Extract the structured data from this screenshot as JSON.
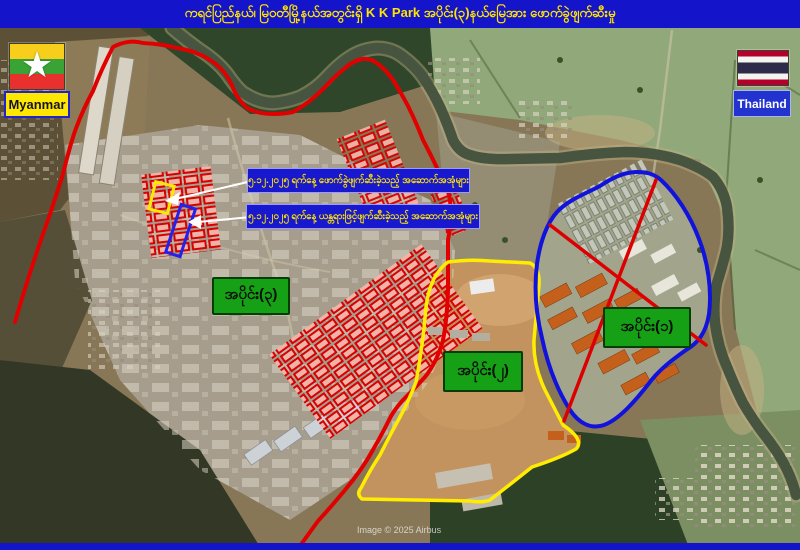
{
  "header": {
    "title": "ကရင်ပြည်နယ်၊ မြဝတီမြို့နယ်အတွင်းရှိ  K K Park အပိုင်း(၃)နယ်မြေအား ဖောက်ခွဲဖျက်ဆီးမှု",
    "bar_color": "#1414cb",
    "text_color": "#ffe400"
  },
  "map": {
    "myanmar_flag_label": "Myanmar",
    "thailand_flag_label": "Thailand",
    "star_icon": "★",
    "callouts": [
      {
        "text": "၅.၁၂.၂၀၂၅ ရက်နေ့  ဖောက်ခွဲဖျက်ဆီးခဲ့သည့်  အဆောက်အအုံများ",
        "highlight_color": "#ffe800"
      },
      {
        "text": "၅.၁၂.၂၀၂၅ ရက်နေ့  ယန္တရားဖြင့်ဖျက်ဆီးခဲ့သည့်  အဆောက်အအုံများ",
        "highlight_color": "#2222ee"
      }
    ],
    "regions": [
      {
        "label": "အပိုင်း(၁)",
        "outline_color": "#1212dd",
        "marking": "red-x-cross"
      },
      {
        "label": "အပိုင်း(၂)",
        "outline_color": "#ffec00",
        "marking": "none"
      },
      {
        "label": "အပိုင်း(၃)",
        "outline_color": "#e10000",
        "marking": "red-building-grid"
      }
    ],
    "section_label_bg": "#16a016",
    "credit": "Image © 2025 Airbus"
  }
}
